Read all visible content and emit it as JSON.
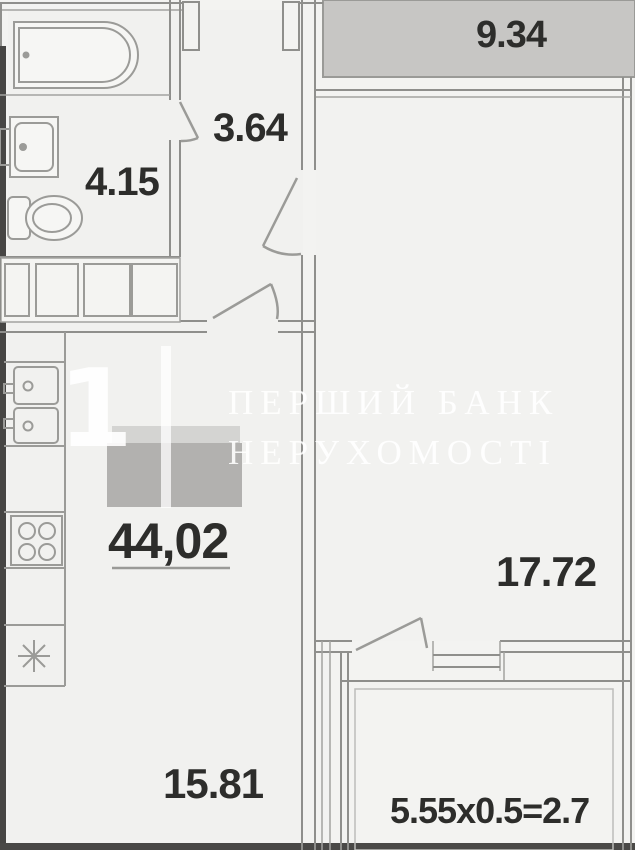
{
  "plan": {
    "title": "apartment-floor-plan",
    "labels": {
      "loggia_top": "9.34",
      "hallway": "3.64",
      "bathroom": "4.15",
      "total_area": "44,02",
      "bedroom": "17.72",
      "kitchen_living": "15.81",
      "balcony_calc": "5.55x0.5=2.7"
    },
    "watermark": {
      "big_digit": "1",
      "line1": "ПЕРШИЙ БАНК",
      "line2": "НЕРУХОМОСТІ"
    },
    "colors": {
      "background": "#f3f3f1",
      "wall": "#8f8f8c",
      "wall_dark": "#474644",
      "loggia_fill": "#c7c6c4",
      "redaction_fill": "#b2b1af",
      "label_text": "#2d2d2b",
      "watermark_white": "#ffffff"
    }
  }
}
